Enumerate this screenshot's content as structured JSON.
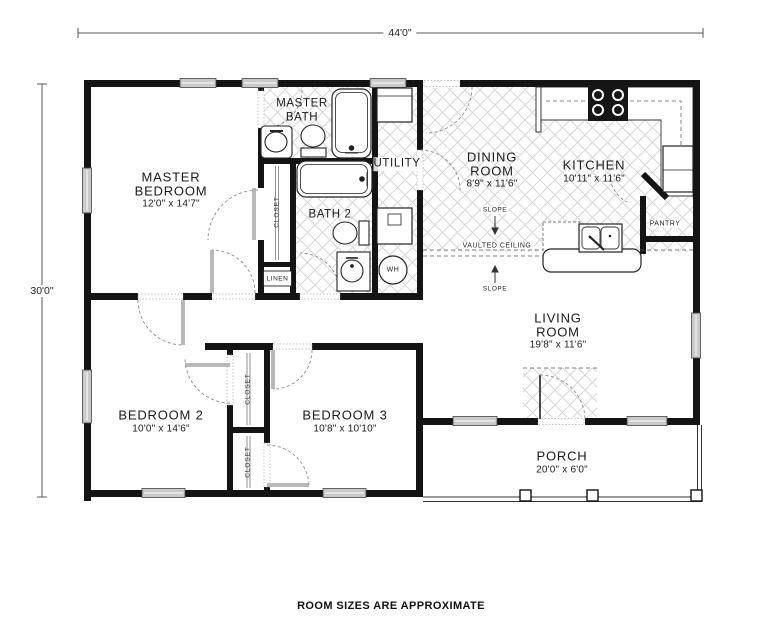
{
  "plan": {
    "width_dim": "44'0\"",
    "height_dim": "30'0\"",
    "footer_note": "ROOM SIZES ARE APPROXIMATE"
  },
  "rooms": {
    "master_bedroom": {
      "name_line1": "MASTER",
      "name_line2": "BEDROOM",
      "size": "12'0\" x 14'7\""
    },
    "master_bath": {
      "name_line1": "MASTER",
      "name_line2": "BATH"
    },
    "bath_2": {
      "name_line1": "BATH 2"
    },
    "utility": {
      "name_line1": "UTILITY"
    },
    "dining_room": {
      "name_line1": "DINING",
      "name_line2": "ROOM",
      "size": "8'9\" x 11'6\""
    },
    "kitchen": {
      "name_line1": "KITCHEN",
      "size": "10'11\" x 11'6\""
    },
    "living_room": {
      "name_line1": "LIVING",
      "name_line2": "ROOM",
      "size": "19'8\" x 11'6\""
    },
    "bedroom_2": {
      "name_line1": "BEDROOM 2",
      "size": "10'0\" x 14'6\""
    },
    "bedroom_3": {
      "name_line1": "BEDROOM 3",
      "size": "10'8\" x 10'10\""
    },
    "porch": {
      "name_line1": "PORCH",
      "size": "20'0\" x 6'0\""
    }
  },
  "annotations": {
    "closet_master": "CLOSET",
    "closet_bedroom2": "CLOSET",
    "closet_bedroom3": "CLOSET",
    "linen": "LINEN",
    "pantry": "PANTRY",
    "water_heater": "WH",
    "slope_dining": "SLOPE",
    "slope_living": "SLOPE",
    "vaulted_ceiling": "VAULTED CEILING"
  },
  "colors": {
    "wall": "#141414",
    "window_fill": "#c9c9c9",
    "hatch_line": "#d6d6d6",
    "arc": "#8a8a8a"
  }
}
